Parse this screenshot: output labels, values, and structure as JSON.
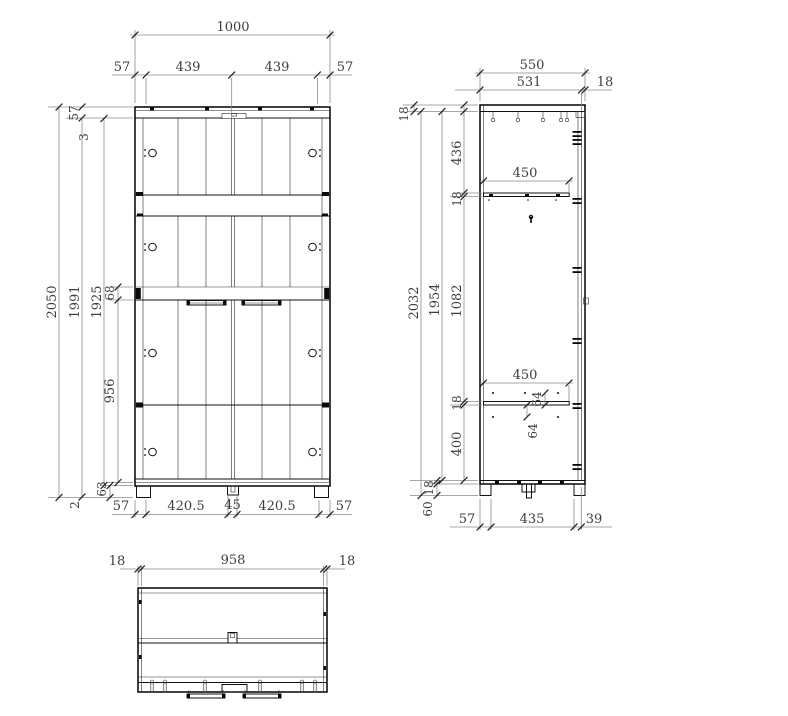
{
  "front": {
    "total_width": "1000",
    "top_chain": [
      "57",
      "439",
      "439",
      "57"
    ],
    "height_total": "2050",
    "height_inner": "1991",
    "door_height": "1925",
    "top_panel": "57",
    "top_gap": "3",
    "mid_shelf": "68",
    "lower_section": "956",
    "bottom_rail": "63",
    "floor_gap": "2",
    "bottom_chain": [
      "57",
      "420.5",
      "45",
      "420.5",
      "57"
    ]
  },
  "side": {
    "depth_total": "550",
    "depth_inner": "531",
    "back_panel": "18",
    "top_panel": "18",
    "height_total": "2032",
    "height_inner": "1954",
    "upper_section": "436",
    "shelf_a": "18",
    "middle_section": "1082",
    "shelf_b": "18",
    "lower_section": "400",
    "bottom_panel": "18",
    "plinth": "60",
    "shelf_depth_upper": "450",
    "shelf_depth_lower": "450",
    "hole_offset_upper": "64",
    "hole_offset_lower": "64",
    "bottom_chain": [
      "57",
      "435",
      "39"
    ]
  },
  "plan": {
    "left_overhang": "18",
    "inner_width": "958",
    "right_overhang": "18"
  }
}
